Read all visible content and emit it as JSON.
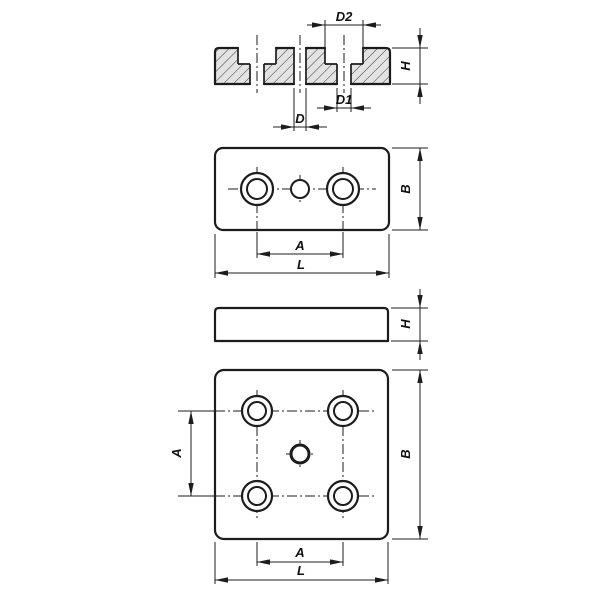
{
  "drawing": {
    "background_color": "#ffffff",
    "line_color": "#1c1c1c",
    "plate_fill_color": "#e3e3e3",
    "hatch_line_color": "#3c3c3c",
    "views": {
      "section": {
        "name": "cross-section-view",
        "labels": {
          "counterbore_diameter": "D2",
          "pilot_hole_diameter": "D1",
          "center_hole_diameter": "D",
          "plate_height": "H"
        }
      },
      "rectangular_plate_top": {
        "name": "top-view-rectangular-plate",
        "labels": {
          "plate_width": "B",
          "hole_spacing": "A",
          "plate_length": "L"
        }
      },
      "side": {
        "name": "side-view",
        "labels": {
          "plate_height": "H"
        }
      },
      "square_plate_top": {
        "name": "top-view-square-plate",
        "labels": {
          "hole_spacing_vertical": "A",
          "plate_width": "B",
          "hole_spacing_horizontal": "A",
          "plate_length": "L"
        }
      }
    }
  }
}
